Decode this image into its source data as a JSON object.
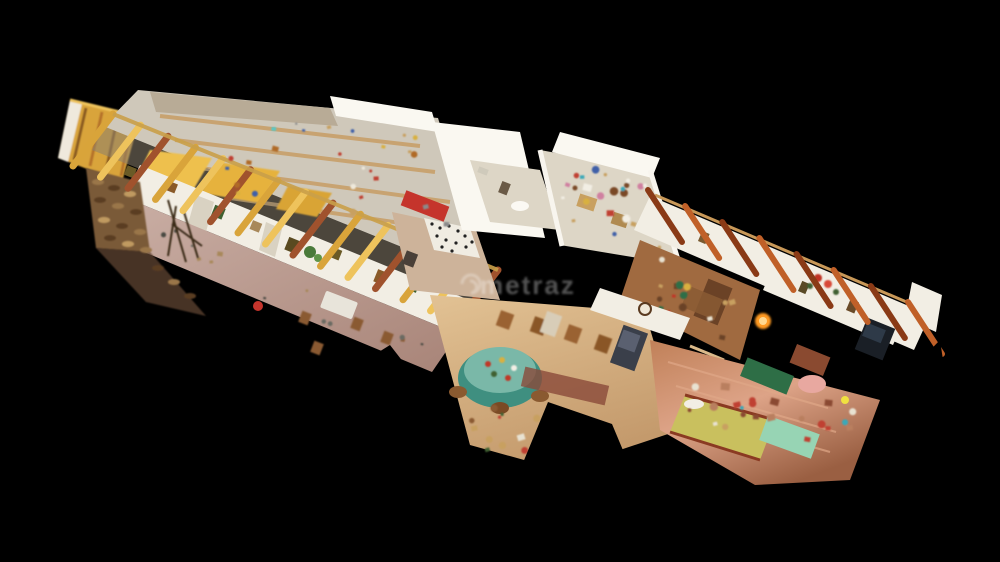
{
  "viewer": {
    "type": "3d-dollhouse-scan-view",
    "description": "Cut-away dollhouse view of a long scanned house interior on a black background",
    "background": "#000000"
  },
  "watermark": {
    "text": "metraz",
    "logo": "swirl-icon",
    "color": "#ffffff",
    "opacity": 0.32
  },
  "palette": {
    "bg": "#000000",
    "wall": "#f2eee4",
    "wallShade": "#ddd6c6",
    "wallBright": "#faf8f1",
    "beamGold": "#d9a43a",
    "beamGoldLight": "#eec35c",
    "beamStripe": "#a0522d",
    "beamDark": "#8a3a16",
    "beamDarkLight": "#c06028",
    "atticFloor": "#cfc8ba",
    "corridorFloor": "#b5948c",
    "corridorFloorLight": "#cbb0a6",
    "woodFloor": "#a06a40",
    "woodDark": "#6b4226",
    "copperFloor": "#b97f5e",
    "copperLight": "#dda387",
    "livingFloor": "#d2ab7d",
    "livingLight": "#e2c294",
    "bedRed": "#c5342c",
    "teal": "#3f8f80",
    "tealLight": "#7ab8a8",
    "mint": "#97d4b4",
    "bedYellow": "#c9c05e",
    "deskGreen": "#2e6e46",
    "clockFace": "#f0e8d8",
    "firewood": "#7a5a38",
    "wmColor": "#ffffff"
  },
  "scene": {
    "rooms": [
      {
        "id": "attic-storage",
        "floor": "atticFloor"
      },
      {
        "id": "corridor-gallery",
        "floor": "corridorFloor"
      },
      {
        "id": "spotted-bed-bedroom",
        "floor": "corridorFloorLight"
      },
      {
        "id": "white-bathroom",
        "floor": "wallShade"
      },
      {
        "id": "cluttered-storage-room",
        "floor": "wallShade"
      },
      {
        "id": "kitchen-wood-room",
        "floor": "woodFloor"
      },
      {
        "id": "living-dining-room",
        "floor": "livingFloor"
      },
      {
        "id": "copper-floor-bedroom",
        "floor": "copperFloor"
      }
    ],
    "roof_beams": {
      "left": {
        "x1": 103,
        "y1": 126,
        "x2": 488,
        "y2": 282,
        "count": 15,
        "dx1": 10,
        "dy1": -12,
        "dx2": -30,
        "dy2": 40,
        "width": 7,
        "colors": [
          "beamGold",
          "beamGoldLight",
          "beamStripe"
        ]
      },
      "right": {
        "x1": 660,
        "y1": 208,
        "x2": 920,
        "y2": 320,
        "count": 8,
        "dx1": -12,
        "dy1": -18,
        "dx2": 22,
        "dy2": 34,
        "width": 6,
        "colors": [
          "beamDark",
          "beamDarkLight"
        ]
      }
    },
    "wall_pictures": {
      "x1": 128,
      "y1": 170,
      "x2": 452,
      "y2": 300,
      "count": 9,
      "colors": [
        "#6a5a26",
        "#8a5a28",
        "#3f6030",
        "#a8885a",
        "#5a4a20"
      ]
    },
    "clutter_regions": [
      {
        "name": "attic-clutter",
        "o": [
          200,
          108
        ],
        "U": [
          220,
          27
        ],
        "V": [
          35,
          90
        ],
        "count": 26,
        "sizes": [
          2,
          7
        ],
        "colors": [
          "#57c8c8",
          "#c04030",
          "#d8b040",
          "#4060a8",
          "#c8a060",
          "#eee8da",
          "#8a8a8a",
          "#b06a28"
        ]
      },
      {
        "name": "storage-clutter",
        "o": [
          548,
          158
        ],
        "U": [
          100,
          16
        ],
        "V": [
          28,
          88
        ],
        "count": 30,
        "sizes": [
          3,
          9
        ],
        "colors": [
          "#3aa8b8",
          "#c04030",
          "#d8b040",
          "#4060a8",
          "#d080a0",
          "#c8a060",
          "#f2eee4",
          "#7a4a28"
        ]
      },
      {
        "name": "kitchen-clutter",
        "o": [
          650,
          252
        ],
        "U": [
          105,
          44
        ],
        "V": [
          -14,
          48
        ],
        "count": 16,
        "sizes": [
          3,
          8
        ],
        "colors": [
          "#c03828",
          "#2e6e46",
          "#c8a060",
          "#6b4226",
          "#e8e2d2",
          "#d8b040"
        ]
      },
      {
        "name": "living-clutter",
        "o": [
          462,
          400
        ],
        "U": [
          95,
          16
        ],
        "V": [
          -6,
          44
        ],
        "count": 12,
        "sizes": [
          3,
          8
        ],
        "colors": [
          "#8a5a30",
          "#c04030",
          "#3f6030",
          "#c8a060",
          "#e8e2d2"
        ]
      },
      {
        "name": "bedroom-right-clutter",
        "o": [
          675,
          362
        ],
        "U": [
          180,
          40
        ],
        "V": [
          -8,
          60
        ],
        "count": 22,
        "sizes": [
          3,
          9
        ],
        "colors": [
          "#b97f5e",
          "#3aa8b8",
          "#c04030",
          "#c8a060",
          "#8a4a30",
          "#e8e2d2"
        ]
      },
      {
        "name": "corridor-items",
        "o": [
          115,
          205
        ],
        "U": [
          320,
          122
        ],
        "V": [
          -16,
          32
        ],
        "count": 14,
        "sizes": [
          2,
          6
        ],
        "colors": [
          "#8a5a30",
          "#6a6a62",
          "#a8885a",
          "#4a4a42"
        ]
      }
    ]
  }
}
